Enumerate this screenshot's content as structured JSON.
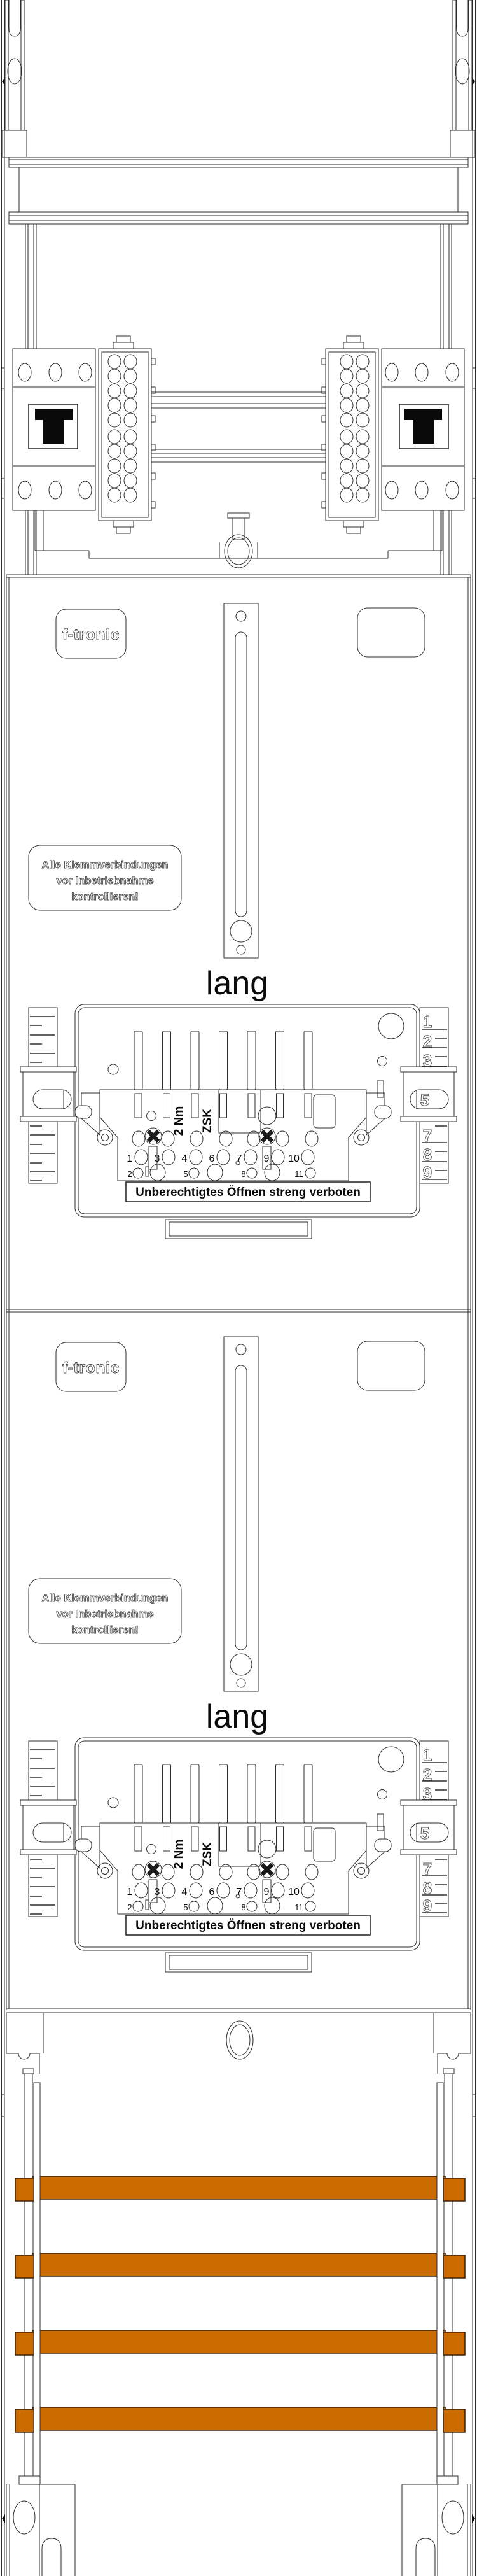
{
  "colors": {
    "line": "#2e2e2e",
    "busbar": "#CC6B00",
    "busbar_edge": "#3A2108"
  },
  "branding": {
    "logo": "f-tronic"
  },
  "section_labels": {
    "warning": {
      "line1": "Alle Klemmverbindungen",
      "line2": "vor Inbetriebnahme",
      "line3": "kontrollieren!"
    },
    "length_marking": "lang",
    "seal_warning": "Unberechtigtes Öffnen streng verboten"
  },
  "terminal_block": {
    "torque": "2 Nm",
    "type": "ZSK",
    "row1_numbers": [
      "1",
      "3",
      "4",
      "6",
      "7",
      "9",
      "10"
    ],
    "row2_numbers": [
      "2",
      "5",
      "8",
      "11"
    ],
    "ruler": {
      "top": [
        "1",
        "2",
        "3"
      ],
      "slider": "5",
      "bottom": [
        "7",
        "8",
        "9"
      ]
    }
  },
  "busbars": {
    "count": 4
  }
}
